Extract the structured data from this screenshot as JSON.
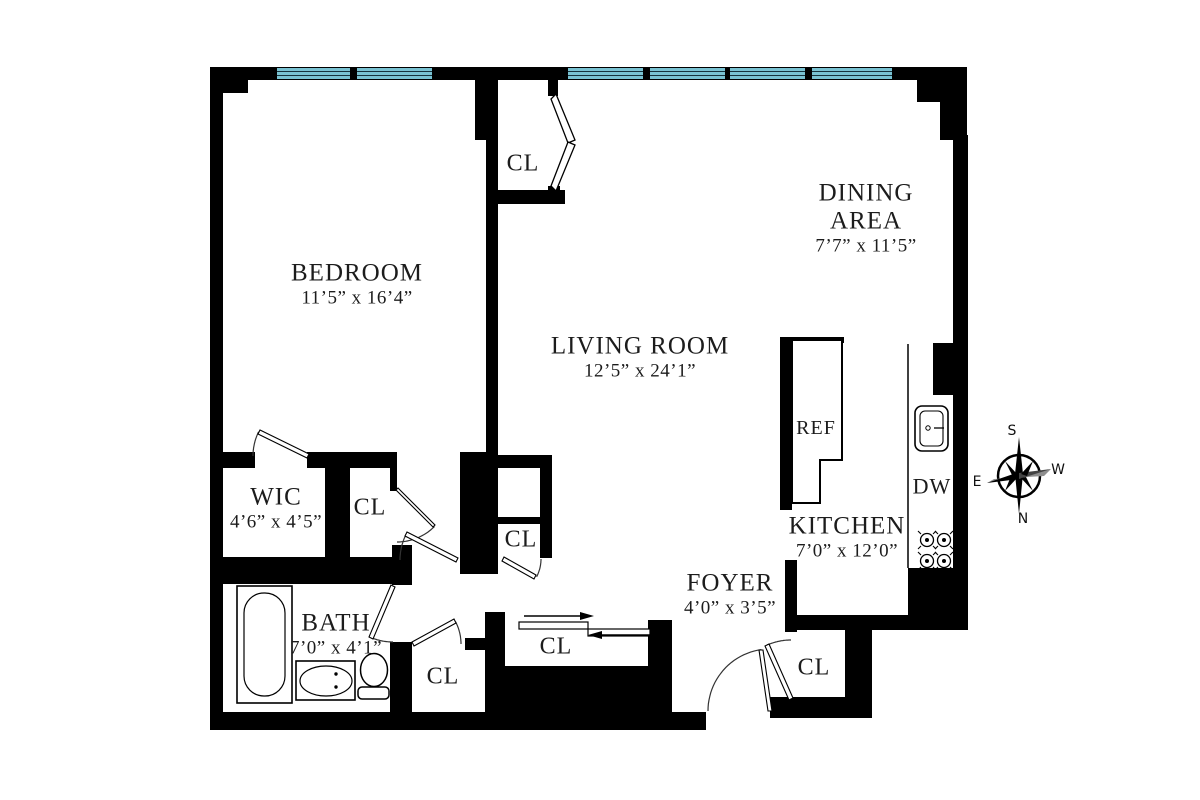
{
  "colors": {
    "wall": "#000000",
    "window_glass": "#79c2d2",
    "window_line": "#16323c",
    "text": "#1c1c1c",
    "compass_gray": "#8e8e8e"
  },
  "rooms": [
    {
      "id": "bedroom",
      "name": "BEDROOM",
      "dims": "11’5” x 16’4”"
    },
    {
      "id": "living_room",
      "name": "LIVING ROOM",
      "dims": "12’5” x 24’1”"
    },
    {
      "id": "dining_area",
      "name": "DINING AREA",
      "dims": "7’7” x 11’5”"
    },
    {
      "id": "kitchen",
      "name": "KITCHEN",
      "dims": "7’0” x 12’0”"
    },
    {
      "id": "wic",
      "name": "WIC",
      "dims": "4’6” x 4’5”"
    },
    {
      "id": "bath",
      "name": "BATH",
      "dims": "7’0” x 4’1”"
    },
    {
      "id": "foyer",
      "name": "FOYER",
      "dims": "4’0” x 3’5”"
    }
  ],
  "closets": [
    {
      "label": "CL"
    },
    {
      "label": "CL"
    },
    {
      "label": "CL"
    },
    {
      "label": "CL"
    },
    {
      "label": "CL"
    },
    {
      "label": "CL"
    }
  ],
  "appliances": {
    "refrigerator": "REF",
    "dishwasher": "DW"
  },
  "compass": {
    "top": "S",
    "bottom": "N",
    "left": "E",
    "right": "W"
  }
}
